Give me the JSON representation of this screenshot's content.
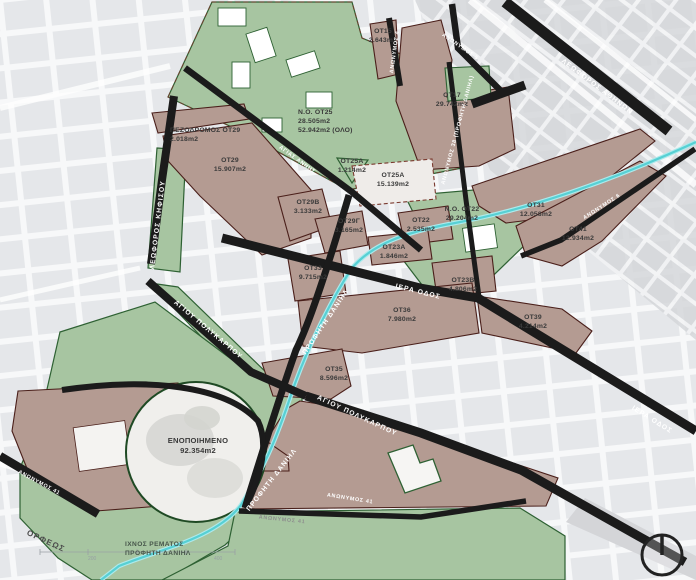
{
  "parcels": [
    {
      "id": "ot15",
      "name": "ΟΤ15",
      "area": "2.643m2"
    },
    {
      "id": "ot17",
      "name": "ΟΤ17",
      "area": "29.742m2"
    },
    {
      "id": "pezodromos-ot29",
      "name": "ΠΕΖΟΔΡΟΜΟΣ ΟΤ29",
      "area": "2.018m2"
    },
    {
      "id": "no-ot25",
      "name": "Ν.Ο. ΟΤ25",
      "area": "28.505m2",
      "area2": "52.942m2 (ΟΛΟ)"
    },
    {
      "id": "ot29",
      "name": "ΟΤ29",
      "area": "15.907m2"
    },
    {
      "id": "ot25a-small",
      "name": "ΟΤ25Α",
      "area": "1.214m2"
    },
    {
      "id": "ot25a",
      "name": "ΟΤ25Α",
      "area": "15.139m2"
    },
    {
      "id": "ot29b",
      "name": "ΟΤ29Β",
      "area": "3.133m2"
    },
    {
      "id": "ot29g",
      "name": "ΟΤ29Γ",
      "area": "3.165m2"
    },
    {
      "id": "no-ot22",
      "name": "Ν.Ο. ΟΤ22",
      "area": "29.204m2"
    },
    {
      "id": "ot31",
      "name": "ΟΤ31",
      "area": "12.058m2"
    },
    {
      "id": "ot22",
      "name": "ΟΤ22",
      "area": "2.535m2"
    },
    {
      "id": "ot41",
      "name": "ΟΤ41",
      "area": "12.934m2"
    },
    {
      "id": "ot23a",
      "name": "ΟΤ23Α",
      "area": "1.846m2"
    },
    {
      "id": "ot33",
      "name": "ΟΤ33",
      "area": "9.715m2"
    },
    {
      "id": "ot23b",
      "name": "ΟΤ23Β",
      "area": "4.806m2"
    },
    {
      "id": "ot36",
      "name": "ΟΤ36",
      "area": "7.980m2"
    },
    {
      "id": "ot39",
      "name": "ΟΤ39",
      "area": "4.214m2"
    },
    {
      "id": "ot35",
      "name": "ΟΤ35",
      "area": "8.596m2"
    },
    {
      "id": "enopoiimeno",
      "name": "ΕΝΟΠΟΙΗΜΕΝΟ",
      "area": "92.354m2"
    }
  ],
  "streets": {
    "leoforos_athinon": "ΛΕΩΦΟΡΟΣ ΑΘΗΝΩΝ",
    "leoforos_kifisou": "ΛΕΩΦΟΡΟΣ ΚΗΦΙΣΟΥ",
    "iera_odos": "ΙΕΡΑ ΟΔΟΣ",
    "agiou_polykarpou": "ΑΓΙΟΥ ΠΟΛΥΚΑΡΠΟΥ",
    "profiti_daniil": "ΠΡΟΦΗΤΗ ΔΑΝΙΗΛ",
    "orfeos": "ΟΡΦΕΩΣ",
    "agias_annis": "ΑΓΙΑΣ ΑΝΝΗΣ",
    "anonymos_4": "ΑΝΩΝΥΜΟΣ 4",
    "anonymos_5": "ΑΝΩΝΥΜΟΣ 5",
    "anonymos_6": "ΑΝΩΝΥΜΟΣ 6",
    "anonymos_38": "ΑΝΩΝΥΜΟΣ 38 (ΠΡΟΦΗΤΗ ΔΑΝΙΗΛ)",
    "anonymos_41": "ΑΝΩΝΥΜΟΣ 41"
  },
  "annotations": {
    "stream_label_line1": "ΙΧΝΟΣ ΡΕΜΑΤΟΣ",
    "stream_label_line2": "ΠΡΟΦΗΤΗ ΔΑΝΙΗΛ",
    "scale_200": "200",
    "scale_400": "400"
  },
  "legend_colors": {
    "green_zone": "#a7c5a1",
    "redevelopment_brown": "#b49b92",
    "street_black": "#1b1b1b",
    "stream_cyan": "#57d0d4",
    "parcel_border": "#4a1f1a",
    "green_border": "#2e6133"
  },
  "icons": {
    "compass": "north-compass"
  }
}
